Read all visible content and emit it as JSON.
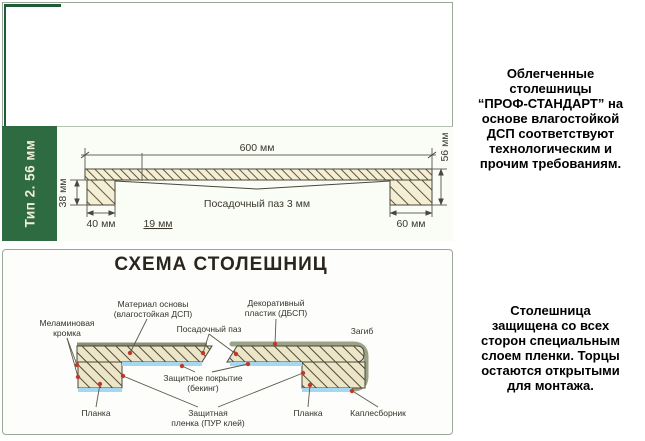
{
  "sidebar": {
    "label": "Тип 2. 56 мм"
  },
  "top_drawing": {
    "dim_600": "600 мм",
    "dim_56": "56 мм",
    "dim_38": "38 мм",
    "dim_40": "40 мм",
    "dim_19": "19 мм",
    "dim_60": "60 мм",
    "groove_label": "Посадочный паз 3 мм"
  },
  "schema": {
    "title": "СХЕМА СТОЛЕШНИЦ",
    "labels": {
      "melamine_1": "Меламиновая",
      "melamine_2": "кромка",
      "base_1": "Материал основы",
      "base_2": "(влагостойкая ДСП)",
      "groove": "Посадочный паз",
      "plastic_1": "Декоративный",
      "plastic_2": "пластик (ДБСП)",
      "bend": "Загиб",
      "backing_1": "Защитное покрытие",
      "backing_2": "(бекинг)",
      "plank_left": "Планка",
      "film_1": "Защитная",
      "film_2": "пленка (ПУР клей)",
      "plank_right": "Планка",
      "drip": "Каплесборник"
    }
  },
  "right_column": {
    "block1": "Облегченные\nстолешницы\n“ПРОФ-СТАНДАРТ” на\nоснове влагостойкой\nДСП соответствуют\nтехнологическим и\nпрочим требованиям.",
    "block2": "Столешница\nзащищена со всех\nсторон специальным\nслоем пленки. Торцы\nостаются открытыми\nдля монтажа."
  },
  "colors": {
    "sidebar_green": "#2e6b41",
    "accent_dark_green": "#1e5c38",
    "panel_border": "#99a899",
    "hatch_fill": "#f3eed4",
    "backing_blue": "#a5d8ef",
    "coating_gray_green": "#9aa287",
    "marker_red": "#c0392b"
  }
}
